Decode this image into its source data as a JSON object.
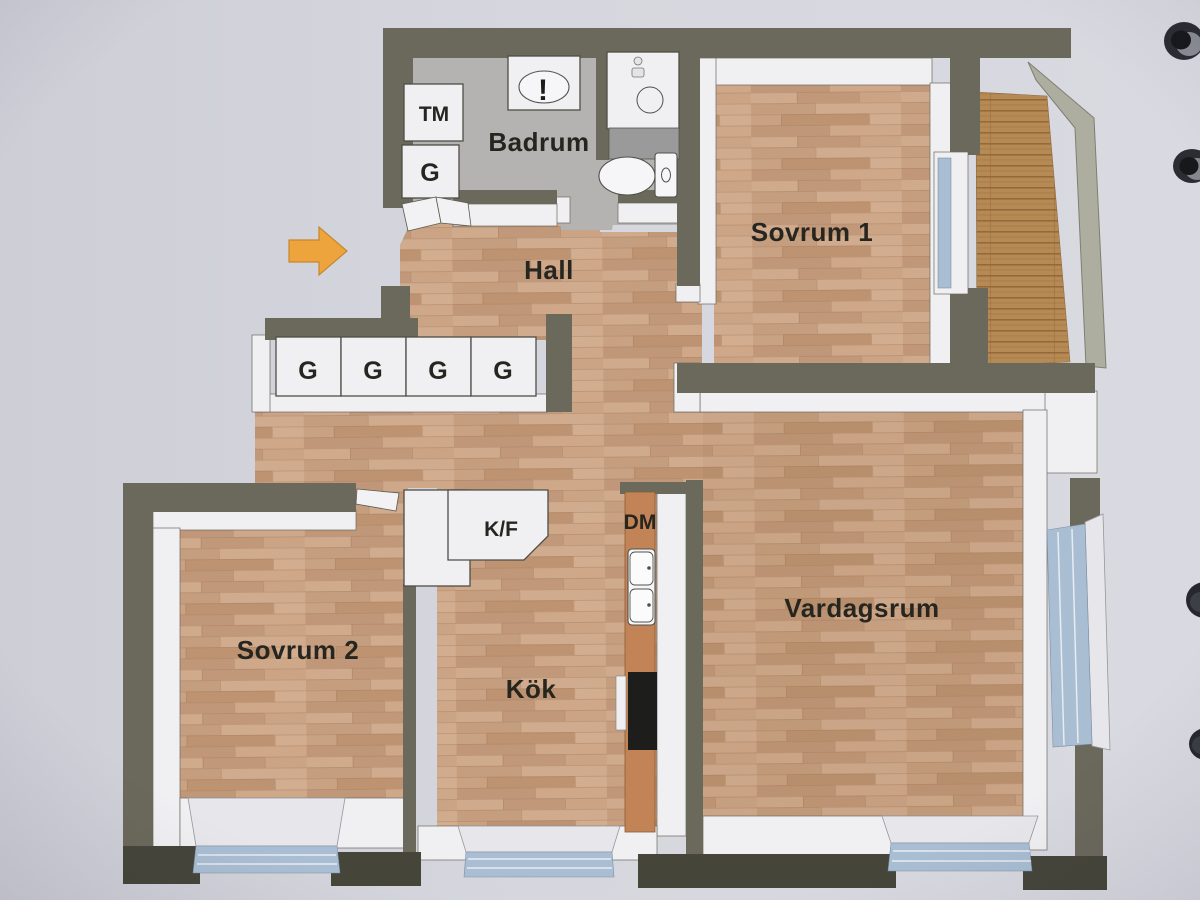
{
  "colors": {
    "paper": "#d4d5dc",
    "wall": "#6b695b",
    "wall_dark": "#45453a",
    "white_face": "#f0f0f3",
    "floor_bathroom": "#b4b3b1",
    "window_glass": "#a9bed3",
    "arrow": "#eea43c",
    "label": "#26251f",
    "railing": "#adae9f",
    "counter_wood": "#c28457",
    "stove": "#1d1d1b",
    "shelf_gray": "#9b9a9b"
  },
  "floor_plan": {
    "rooms": [
      {
        "name": "Badrum"
      },
      {
        "name": "Hall"
      },
      {
        "name": "Sovrum 1"
      },
      {
        "name": "Sovrum 2"
      },
      {
        "name": "Kök"
      },
      {
        "name": "Vardagsrum"
      }
    ],
    "hall_wardrobes": [
      "G",
      "G",
      "G",
      "G"
    ],
    "bathroom": {
      "washing_machine": "TM",
      "wardrobe": "G",
      "sink_mark": "!"
    },
    "kitchen": {
      "fridge_freezer": "K/F",
      "dishwasher": "DM"
    }
  }
}
